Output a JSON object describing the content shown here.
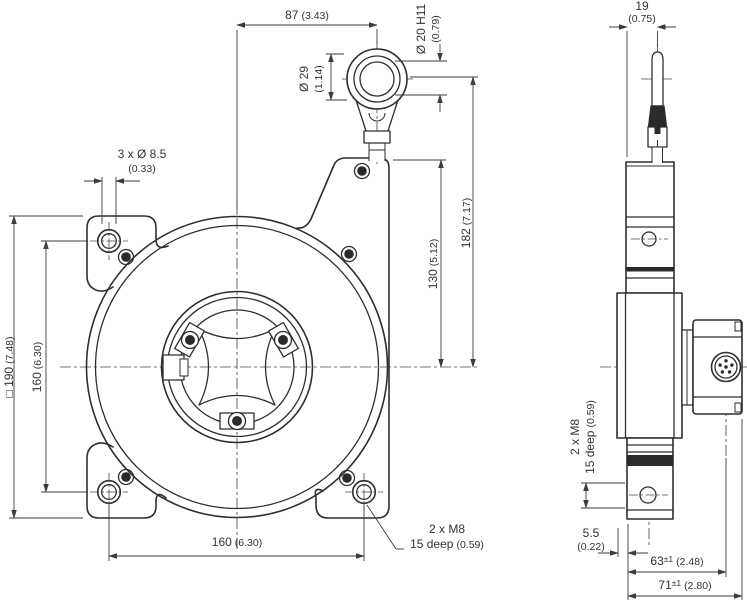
{
  "front_view": {
    "dim_center_to_eyelet": {
      "mm": "87",
      "inch": "(3.43)"
    },
    "dim_eyelet_ring": {
      "mm": "Ø 29",
      "inch": "(1.14)"
    },
    "dim_eyelet_bore": {
      "mm": "Ø 20 H11",
      "inch": "(0.79)"
    },
    "dim_mounting_holes": {
      "mm": "3 x Ø 8.5",
      "inch": "(0.33)"
    },
    "dim_plate_square": {
      "mm": "□ 190",
      "inch": "(7.48)"
    },
    "dim_hole_spacing_vertical": {
      "mm": "160",
      "inch": "(6.30)"
    },
    "dim_eyelet_height": {
      "mm": "182",
      "inch": "(7.17)"
    },
    "dim_outlet_height": {
      "mm": "130",
      "inch": "(5.12)"
    },
    "dim_hole_spacing_horizontal": {
      "mm": "160",
      "inch": "(6.30)"
    },
    "thread_note": {
      "line1": "2 x M8",
      "line2_mm": "15 deep",
      "line2_inch": "(0.59)"
    }
  },
  "side_view": {
    "dim_rope_offset": {
      "mm": "19",
      "inch": "(0.75)"
    },
    "thread_note": {
      "line1": "2 x M8",
      "line2_mm": "15 deep",
      "line2_inch": "(0.59)"
    },
    "dim_bracket_offset": {
      "mm": "5.5",
      "inch": "(0.22)"
    },
    "dim_depth_to_connector": {
      "mm": "63",
      "tol": "±1",
      "inch": "(2.48)"
    },
    "dim_total_depth": {
      "mm": "71",
      "tol": "±1",
      "inch": "(2.80)"
    }
  },
  "colors": {
    "line": "#2e2e2e",
    "dimension": "#3c3c3c",
    "text": "#333333",
    "background": "#ffffff"
  }
}
